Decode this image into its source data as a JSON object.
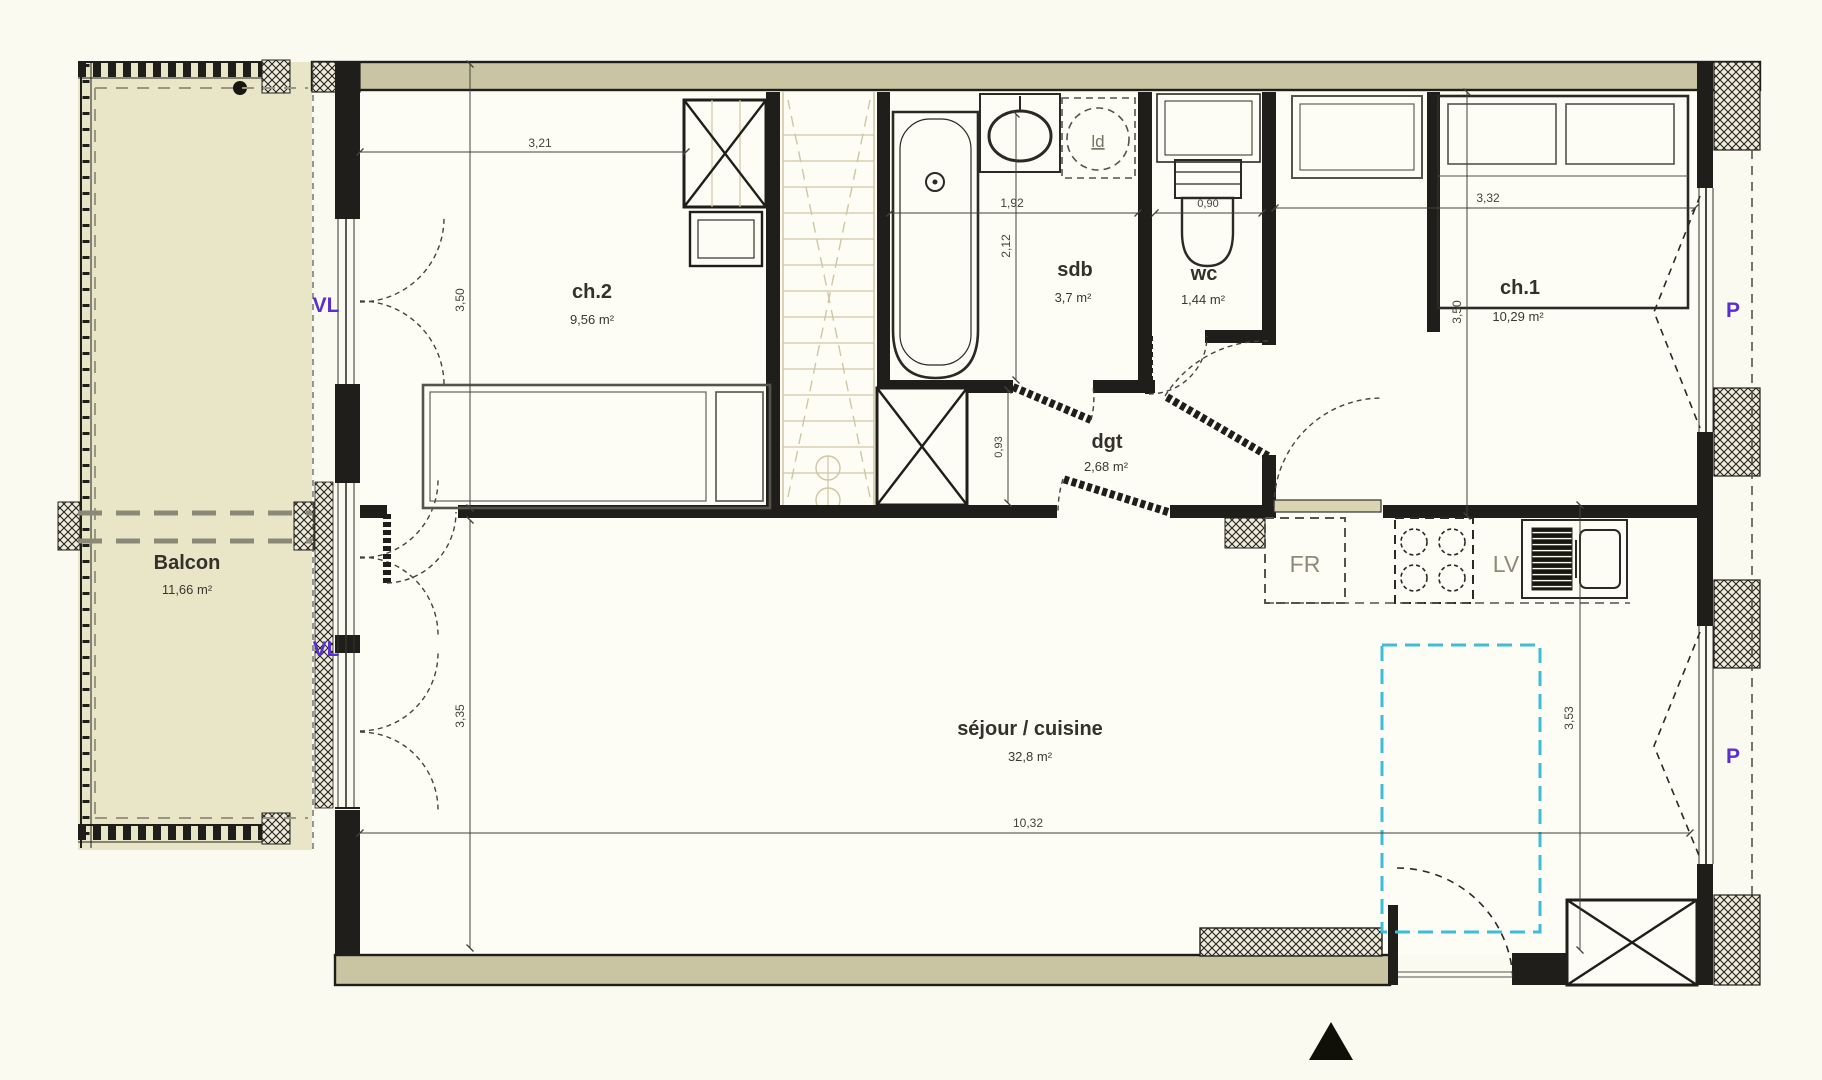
{
  "plan": {
    "type": "apartment-floor-plan",
    "rooms": {
      "balcon": {
        "name": "Balcon",
        "area": "11,66 m²"
      },
      "ch2": {
        "name": "ch.2",
        "area": "9,56 m²"
      },
      "sdb": {
        "name": "sdb",
        "area": "3,7 m²"
      },
      "wc": {
        "name": "wc",
        "area": "1,44 m²"
      },
      "ch1": {
        "name": "ch.1",
        "area": "10,29 m²"
      },
      "dgt": {
        "name": "dgt",
        "area": "2,68 m²"
      },
      "sejour": {
        "name": "séjour / cuisine",
        "area": "32,8 m²"
      }
    },
    "appliances": {
      "fridge": "FR",
      "dishwasher": "LV",
      "washer": "ld"
    },
    "window_labels": {
      "vl1": "VL",
      "vl2": "VL",
      "p1": "P",
      "p2": "P"
    },
    "dimensions": {
      "ch2_width": "3,21",
      "ch2_height": "3,50",
      "sdb_width": "1,92",
      "sdb_height": "2,12",
      "wc_width": "0,90",
      "ch1_width": "3,32",
      "ch1_height": "3,50",
      "dgt_height": "0,93",
      "sejour_left_height": "3,35",
      "sejour_width": "10,32",
      "sejour_right_height": "3,53"
    },
    "colors": {
      "paper": "#fafaf1",
      "wall_fill": "#c9c4a2",
      "balcony_fill": "#e9e6c8",
      "line_black": "#1f1e1a",
      "stair_faint": "#cfc7a2",
      "label_purple": "#5a2fd0",
      "highlight_cyan": "#3dbdd6"
    }
  }
}
